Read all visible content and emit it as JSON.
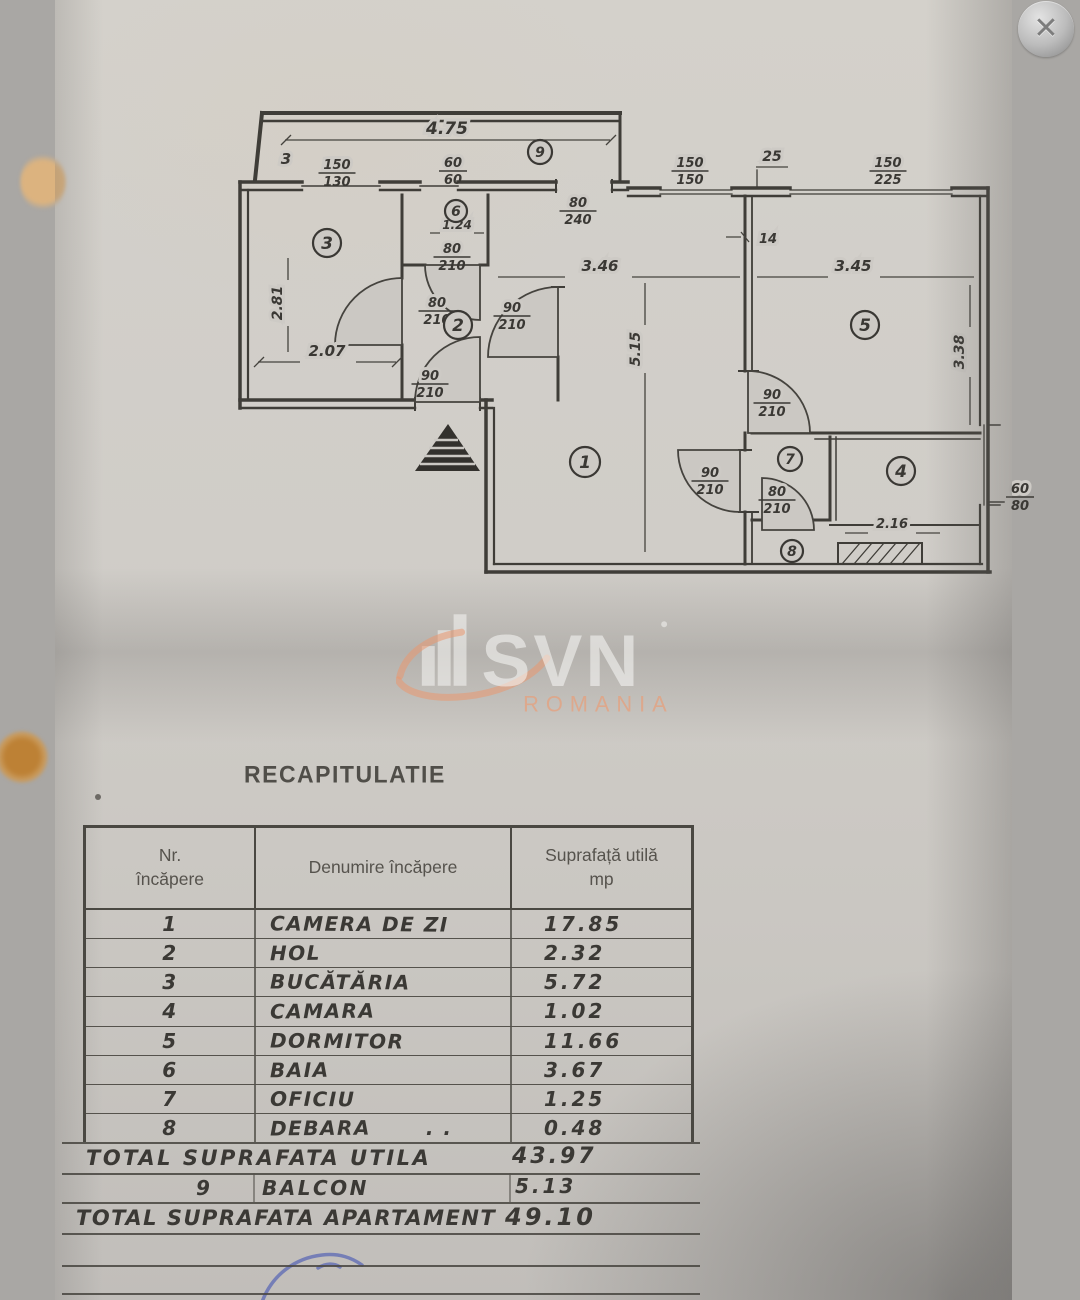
{
  "close_button": {
    "symbol": "✕"
  },
  "watermark": {
    "brand": "SVN",
    "region": "ROMANIA"
  },
  "plan": {
    "room_markers": [
      {
        "n": "9",
        "x": 540,
        "y": 152,
        "r": 12
      },
      {
        "n": "3",
        "x": 327,
        "y": 243,
        "r": 14
      },
      {
        "n": "6",
        "x": 456,
        "y": 211,
        "r": 11
      },
      {
        "n": "2",
        "x": 458,
        "y": 325,
        "r": 14
      },
      {
        "n": "5",
        "x": 865,
        "y": 325,
        "r": 14
      },
      {
        "n": "1",
        "x": 585,
        "y": 462,
        "r": 15
      },
      {
        "n": "7",
        "x": 790,
        "y": 459,
        "r": 12
      },
      {
        "n": "4",
        "x": 901,
        "y": 471,
        "r": 14
      },
      {
        "n": "8",
        "x": 792,
        "y": 551,
        "r": 11
      }
    ],
    "fracs": [
      {
        "num": "150",
        "den": "130",
        "x": 337,
        "y": 172
      },
      {
        "num": "60",
        "den": "60",
        "x": 453,
        "y": 170
      },
      {
        "num": "150",
        "den": "150",
        "x": 690,
        "y": 170
      },
      {
        "num": "150",
        "den": "225",
        "x": 888,
        "y": 170
      },
      {
        "num": "80",
        "den": "240",
        "x": 578,
        "y": 210
      },
      {
        "num": "80",
        "den": "210",
        "x": 452,
        "y": 256
      },
      {
        "num": "80",
        "den": "210",
        "x": 437,
        "y": 310
      },
      {
        "num": "90",
        "den": "210",
        "x": 512,
        "y": 315
      },
      {
        "num": "90",
        "den": "210",
        "x": 430,
        "y": 383
      },
      {
        "num": "90",
        "den": "210",
        "x": 772,
        "y": 402
      },
      {
        "num": "90",
        "den": "210",
        "x": 710,
        "y": 480
      },
      {
        "num": "80",
        "den": "210",
        "x": 777,
        "y": 499
      },
      {
        "num": "60",
        "den": "80",
        "x": 1020,
        "y": 496
      }
    ],
    "dims": [
      {
        "t": "4.75",
        "x": 447,
        "y": 134,
        "fs": 17
      },
      {
        "t": "25",
        "x": 772,
        "y": 161,
        "fs": 14
      },
      {
        "t": "3",
        "x": 286,
        "y": 164,
        "fs": 15
      },
      {
        "t": "1.24",
        "x": 457,
        "y": 229,
        "fs": 12
      },
      {
        "t": "14",
        "x": 768,
        "y": 243,
        "fs": 13
      },
      {
        "t": "3.46",
        "x": 600,
        "y": 271,
        "fs": 15
      },
      {
        "t": "3.45",
        "x": 853,
        "y": 271,
        "fs": 15
      },
      {
        "t": "2.81",
        "x": 282,
        "y": 303,
        "fs": 14,
        "rot": -90
      },
      {
        "t": "2.07",
        "x": 327,
        "y": 356,
        "fs": 15
      },
      {
        "t": "5.15",
        "x": 640,
        "y": 349,
        "fs": 14,
        "rot": -90
      },
      {
        "t": "3.38",
        "x": 964,
        "y": 352,
        "fs": 14,
        "rot": -90
      },
      {
        "t": "2.16",
        "x": 892,
        "y": 528,
        "fs": 13
      }
    ]
  },
  "recap": {
    "title": "RECAPITULATIE",
    "headers": {
      "c1a": "Nr.",
      "c1b": "încăpere",
      "c2": "Denumire încăpere",
      "c3a": "Suprafață utilă",
      "c3b": "mp"
    },
    "rows": [
      {
        "nr": "1",
        "name": "CAMERA DE ZI",
        "area": "17.85",
        "suffix": ""
      },
      {
        "nr": "2",
        "name": "HOL",
        "area": "2.32",
        "suffix": ""
      },
      {
        "nr": "3",
        "name": "BUCĂTĂRIA",
        "area": "5.72",
        "suffix": ""
      },
      {
        "nr": "4",
        "name": "CAMARA",
        "area": "1.02",
        "suffix": ""
      },
      {
        "nr": "5",
        "name": "DORMITOR",
        "area": "11.66",
        "suffix": ""
      },
      {
        "nr": "6",
        "name": "BAIA",
        "area": "3.67",
        "suffix": ""
      },
      {
        "nr": "7",
        "name": "OFICIU",
        "area": "1.25",
        "suffix": ""
      },
      {
        "nr": "8",
        "name": "DEBARA",
        "area": "0.48",
        "suffix": ". ."
      }
    ],
    "total_utila": {
      "label": "TOTAL SUPRAFATA UTILA",
      "value": "43.97"
    },
    "balcon_row": {
      "nr": "9",
      "name": "BALCON",
      "area": "5.13"
    },
    "total_apart": {
      "label": "TOTAL SUPRAFATA APARTAMENT",
      "value": "49.10"
    }
  }
}
